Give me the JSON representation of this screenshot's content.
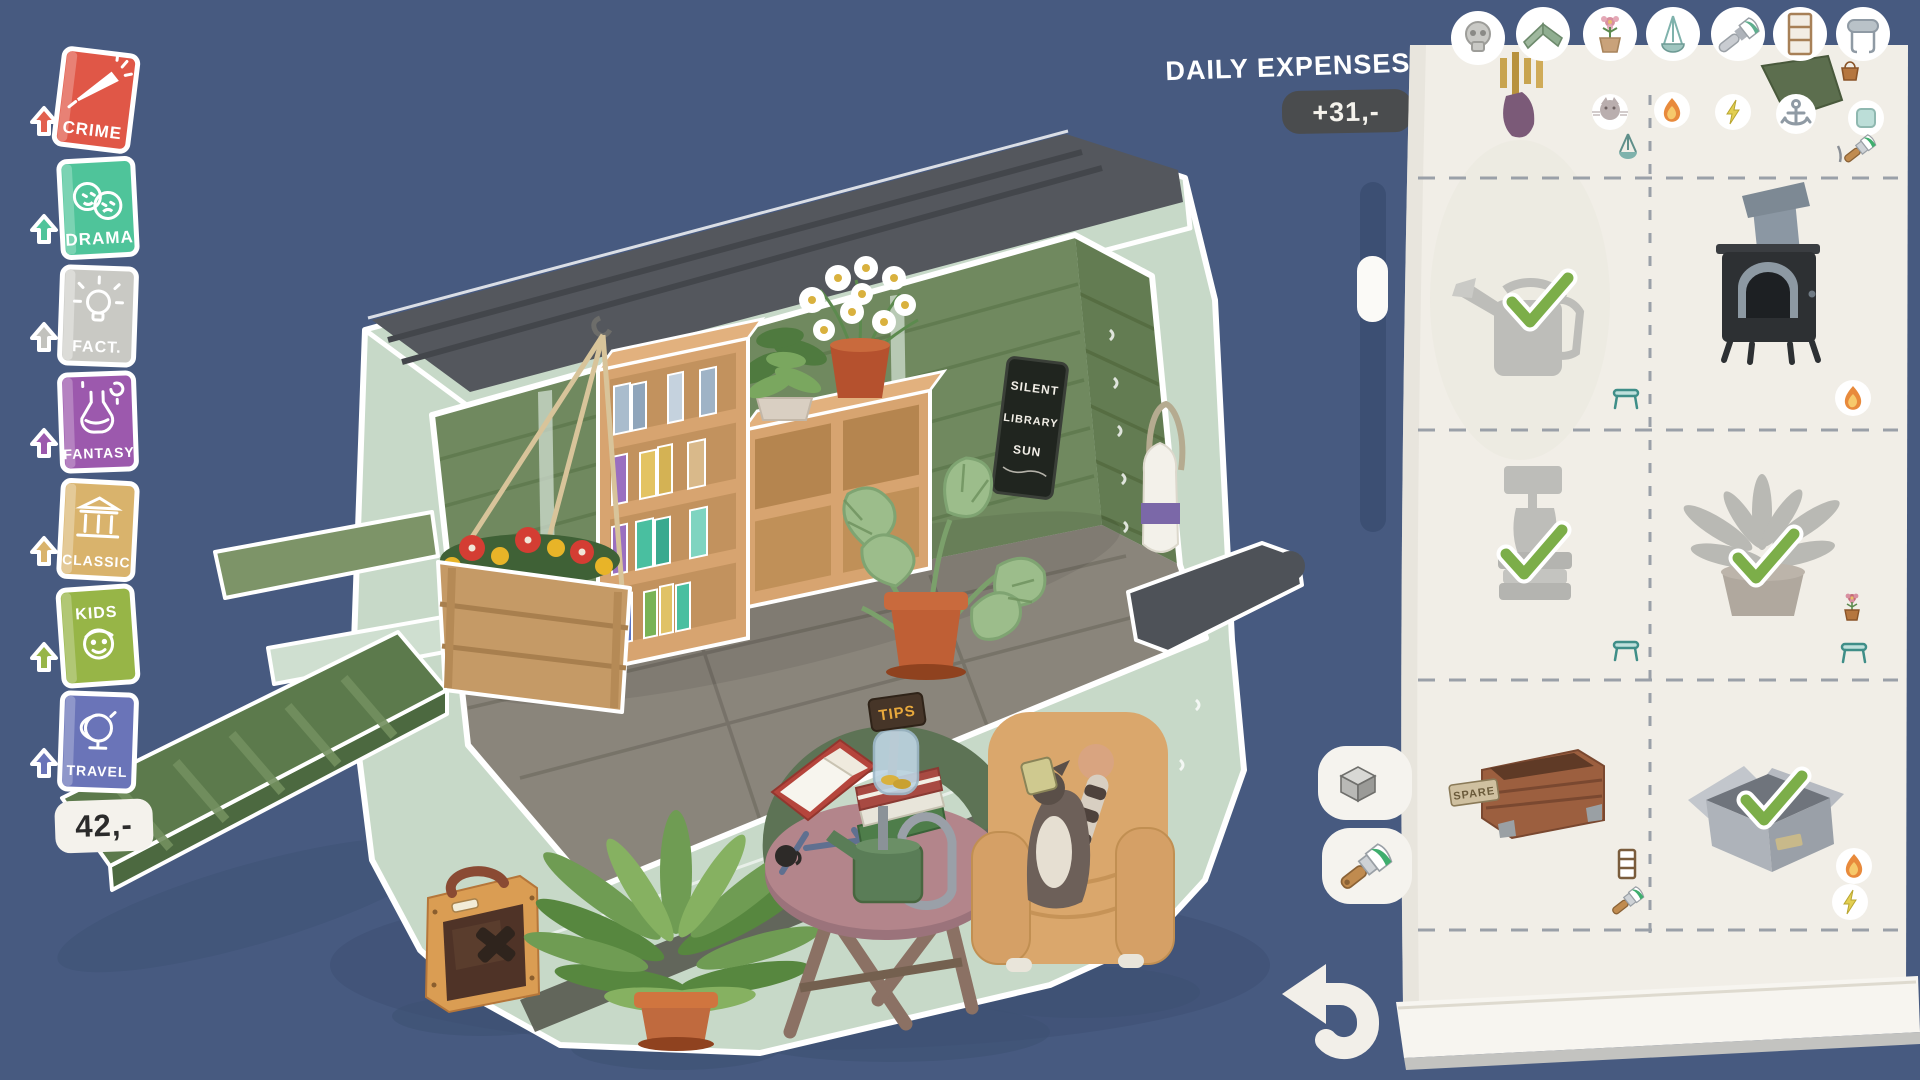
{
  "colors": {
    "background": "#475a80",
    "background_shadow": "#3e5173",
    "paper": "#f1eee7",
    "expense_badge_bg": "#4a4c4e",
    "check_green": "#7cae49",
    "trailer_pale": "#c7d9c8",
    "trailer_wall": "#70895f",
    "wood_shelf": "#d7a470",
    "terracotta": "#bf5f35",
    "chair_tan": "#daa76c",
    "table_rose": "#b3858b"
  },
  "sidebar": {
    "books": [
      {
        "label": "CRIME",
        "color": "#e05747"
      },
      {
        "label": "DRAMA",
        "color": "#4fc49a"
      },
      {
        "label": "FACT.",
        "color": "#c9c9c4"
      },
      {
        "label": "FANTASY",
        "color": "#9c59ad"
      },
      {
        "label": "CLASSIC",
        "color": "#d9b36c"
      },
      {
        "label": "KIDS",
        "color": "#97b547"
      },
      {
        "label": "TRAVEL",
        "color": "#6a74b8"
      }
    ],
    "balance": "42,-"
  },
  "expenses": {
    "label": "DAILY EXPENSES",
    "value": "+31,-"
  },
  "scene": {
    "chalkboard": {
      "lines": [
        "SILENT",
        "LIBRARY",
        "SUN"
      ]
    },
    "tips_sign": "TIPS",
    "items": [
      "bookshelf",
      "hanging-flower-crate",
      "daisy-pot",
      "small-plant",
      "monstera",
      "chalkboard",
      "milk-bottle",
      "ramp",
      "amp-speaker",
      "fern-pot",
      "folding-table",
      "open-book",
      "book-stack",
      "tips-jar",
      "watering-can",
      "mug",
      "armchair",
      "raccoon"
    ]
  },
  "panel": {
    "tabs": [
      {
        "name": "skull"
      },
      {
        "name": "awning"
      },
      {
        "name": "potted-flower"
      },
      {
        "name": "hanging-lamp"
      },
      {
        "name": "paintbrush"
      },
      {
        "name": "shelf"
      },
      {
        "name": "wallpaper-roll"
      }
    ],
    "grid": [
      {
        "cells": [
          {
            "item": "wind chime",
            "owned": false,
            "badges": [
              "cat",
              "hanging-scale"
            ]
          },
          {
            "item": "tarp",
            "owned": false,
            "badges": [
              "fire",
              "lightning",
              "anchor",
              "note",
              "paintbrush"
            ]
          }
        ]
      },
      {
        "cells": [
          {
            "item": "watering can",
            "owned": true,
            "badges": [
              "stool"
            ]
          },
          {
            "item": "wood stove",
            "owned": false,
            "badges": [
              "fire"
            ]
          }
        ]
      },
      {
        "cells": [
          {
            "item": "grinder stand",
            "owned": true,
            "badges": [
              "stool"
            ]
          },
          {
            "item": "potted fern",
            "owned": true,
            "badges": [
              "flower-pot",
              "stool"
            ]
          }
        ]
      },
      {
        "cells": [
          {
            "item": "spare crate",
            "owned": false,
            "tag": "SPARE",
            "badges": [
              "shelf",
              "paintbrush"
            ]
          },
          {
            "item": "cardboard box",
            "owned": true,
            "badges": [
              "fire",
              "lightning"
            ]
          }
        ]
      }
    ],
    "buttons": [
      {
        "name": "cube-view"
      },
      {
        "name": "paint-brush"
      },
      {
        "name": "back"
      }
    ]
  }
}
